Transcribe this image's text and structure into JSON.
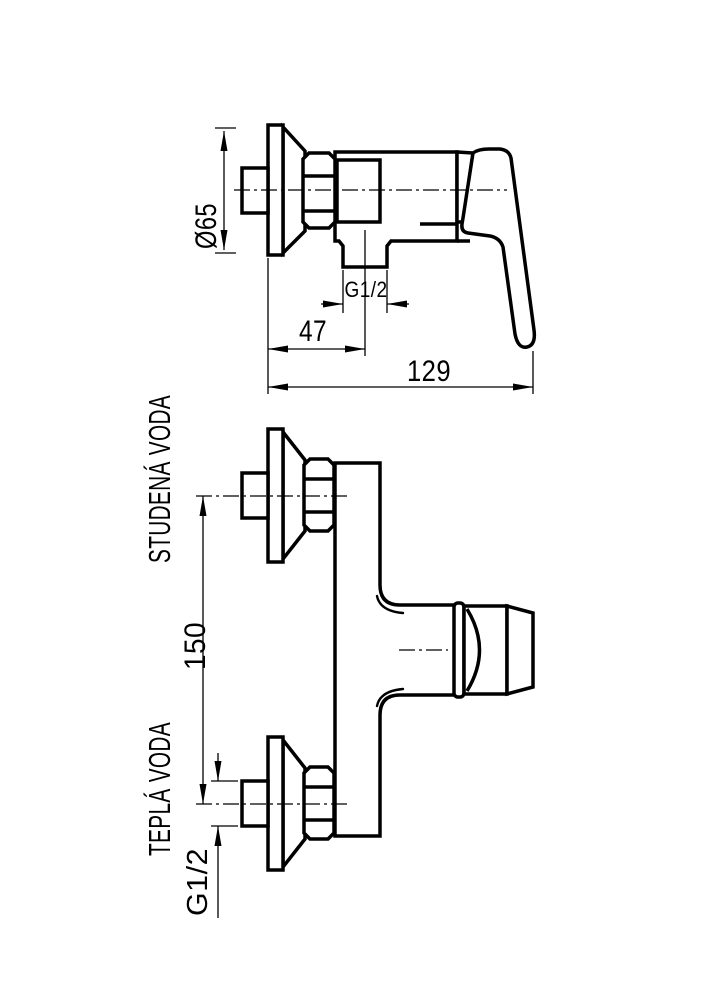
{
  "drawing": {
    "title": "Wall-mounted shower mixer dimension drawing",
    "background_color": "#ffffff",
    "line_color": "#000000",
    "side_view": {
      "diameter_label": "Ø65",
      "outlet_thread_label": "G1/2",
      "outlet_offset_label": "47",
      "overall_depth_label": "129"
    },
    "front_view": {
      "cold_water_label": "STUDENÁ VODA",
      "hot_water_label": "TEPLÁ VODA",
      "inlet_spacing_label": "150",
      "inlet_thread_label": "G1/2"
    }
  }
}
